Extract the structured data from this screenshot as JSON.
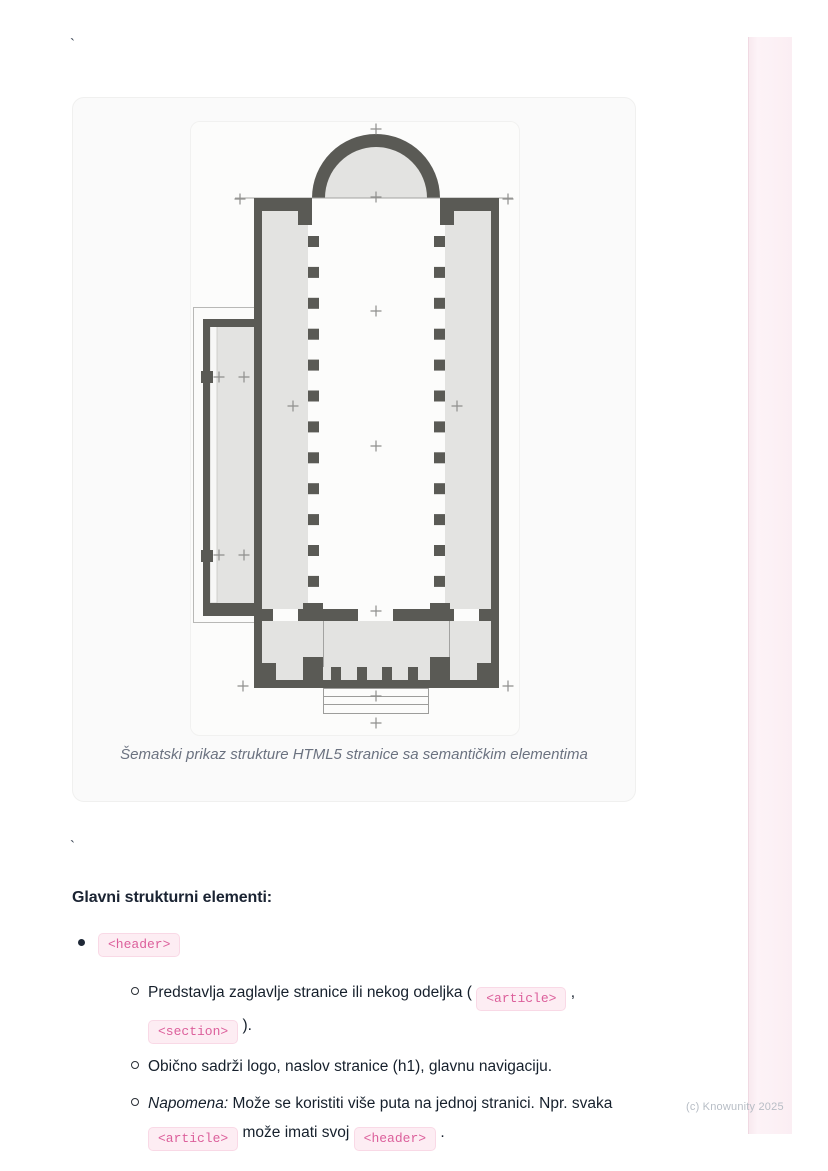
{
  "page": {
    "stray_backtick_top": "`",
    "stray_backtick_middle": "`",
    "watermark": "(c) Knowunity 2025"
  },
  "figure": {
    "image_name": "church-floor-plan-schematic",
    "caption": "Šematski prikaz strukture HTML5 stranice sa semantičkim elementima"
  },
  "content": {
    "heading": "Glavni strukturni elementi:",
    "items": [
      {
        "code": "<header>",
        "subitems": [
          {
            "segments": [
              {
                "type": "text",
                "text": "Predstavlja zaglavlje stranice ili nekog odeljka ( "
              },
              {
                "type": "code",
                "text": "<article>"
              },
              {
                "type": "text",
                "text": " , "
              },
              {
                "type": "code",
                "text": "<section>"
              },
              {
                "type": "text",
                "text": " )."
              }
            ]
          },
          {
            "segments": [
              {
                "type": "text",
                "text": "Obično sadrži logo, naslov stranice (h1), glavnu navigaciju."
              }
            ]
          },
          {
            "segments": [
              {
                "type": "italic",
                "text": "Napomena:"
              },
              {
                "type": "text",
                "text": " Može se koristiti više puta na jednoj stranici. Npr. svaka "
              },
              {
                "type": "code",
                "text": "<article>"
              },
              {
                "type": "text",
                "text": " može imati svoj "
              },
              {
                "type": "code",
                "text": "<header>"
              },
              {
                "type": "text",
                "text": " ."
              }
            ]
          }
        ]
      }
    ]
  },
  "colors": {
    "chip_background": "#fdedf3",
    "chip_text": "#dc5f9b",
    "chip_border": "#f9d9e6",
    "plan_wall": "#5a5a55",
    "plan_fill": "#e3e3e1",
    "caption_text": "#6b7280",
    "body_text": "#141c28",
    "watermark_text": "#b7bdc5",
    "side_strip": "#fbeef3"
  }
}
